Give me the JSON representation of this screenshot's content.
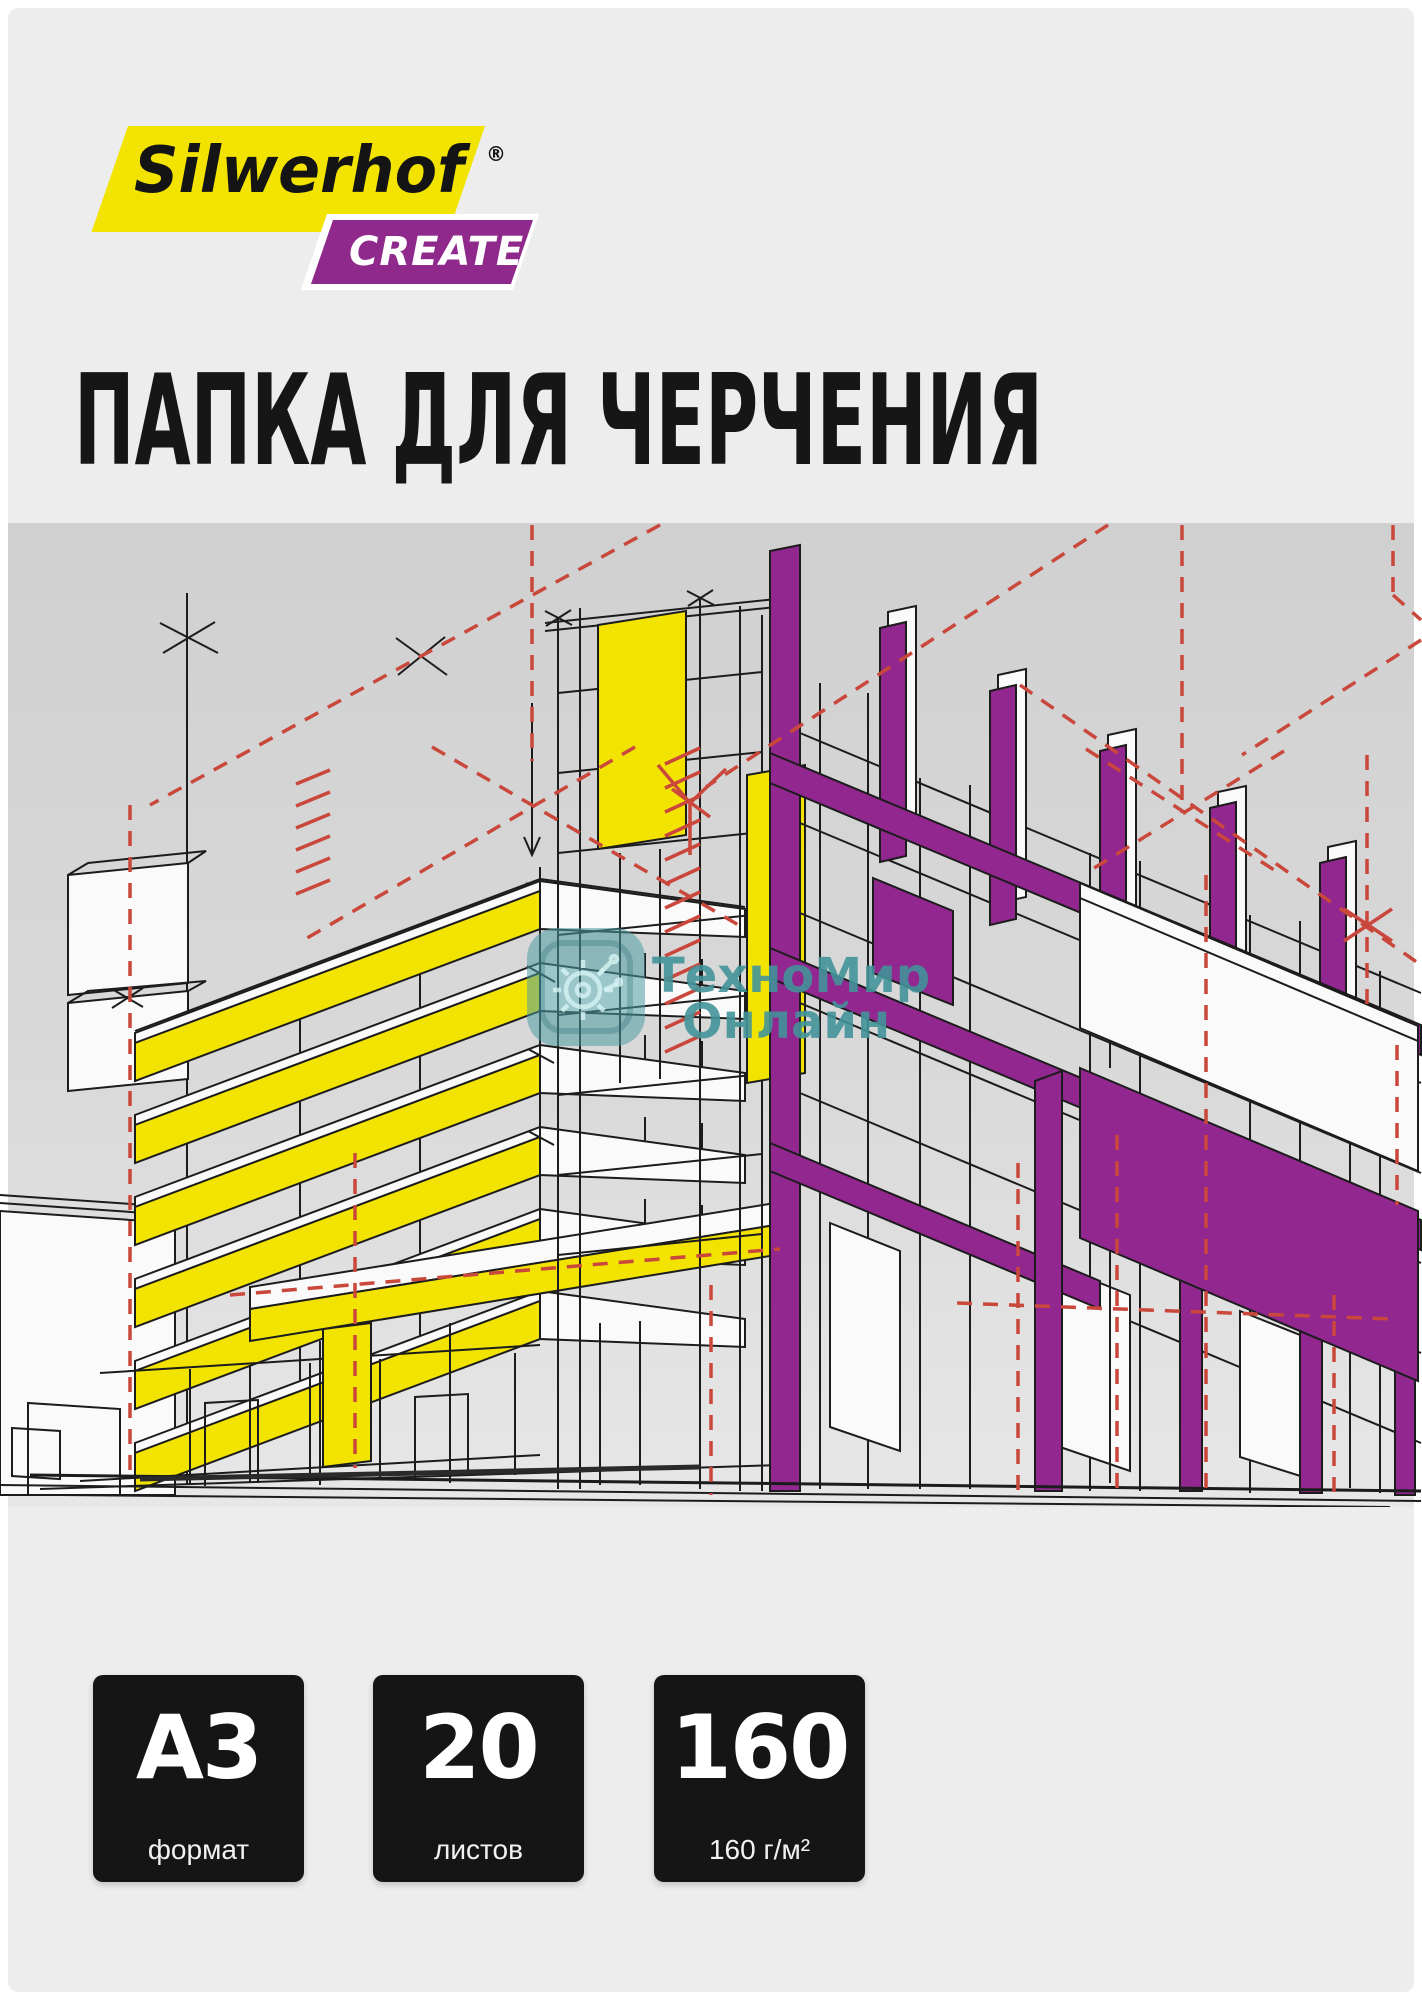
{
  "product_card": {
    "brand": {
      "name": "Silwerhof",
      "registered_mark": "®",
      "line": "CREATE"
    },
    "title": "ПАПКА ДЛЯ ЧЕРЧЕНИЯ",
    "watermark": {
      "line1": "ТехноМир",
      "line2": "Онлайн"
    },
    "specs": [
      {
        "value": "A3",
        "label": "формат"
      },
      {
        "value": "20",
        "label": "листов"
      },
      {
        "value": "160",
        "label": "160 г/м²"
      }
    ],
    "colors": {
      "brand-yellow": "#F2E400",
      "brand-purple": "#8F2A8C",
      "accent-purple": "#91278F",
      "draft-red": "#C9473B",
      "line-black": "#1C1C1C",
      "watermark-teal": "#4E9DA2",
      "card-bg": "#EDEDED",
      "spec-bg": "#151515"
    }
  }
}
